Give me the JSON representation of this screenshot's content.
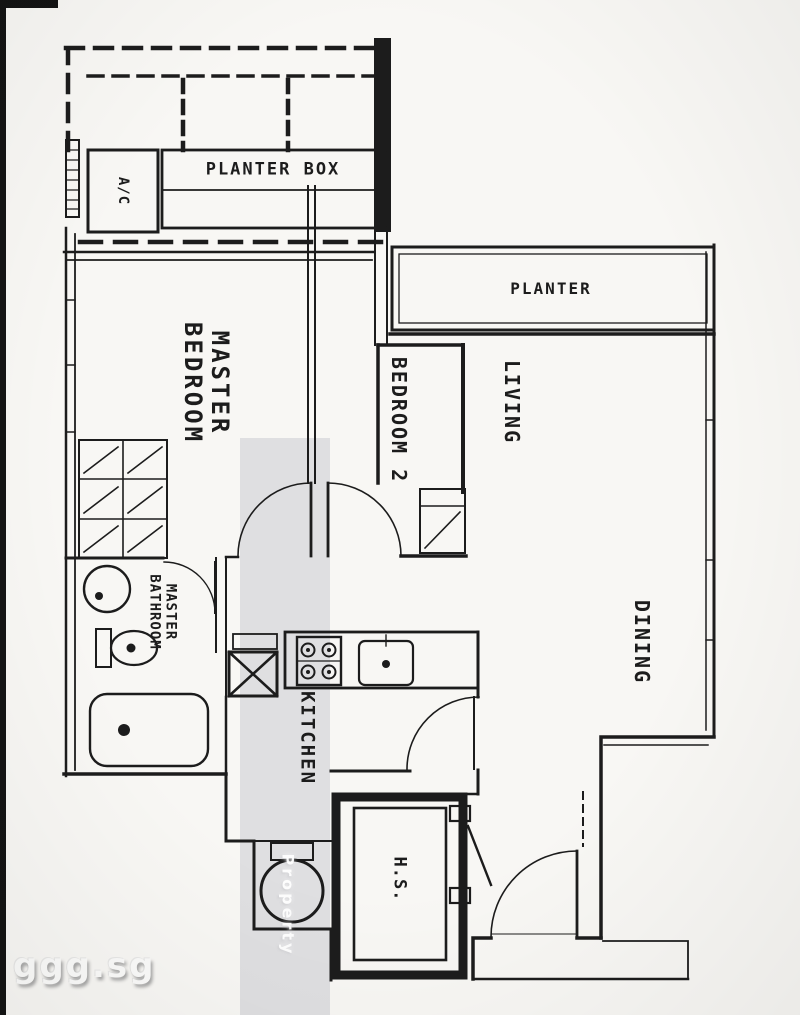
{
  "floorplan": {
    "rooms": {
      "master_bedroom": "MASTER\nBEDROOM",
      "bedroom_2": "BEDROOM 2",
      "living": "LIVING",
      "dining": "DINING",
      "master_bathroom": "MASTER\nBATHROOM",
      "kitchen": "KITCHEN",
      "household_shelter": "H.S."
    },
    "annotations": {
      "planter_box": "PLANTER BOX",
      "planter": "PLANTER",
      "ac_ledge": "A/C"
    },
    "watermarks": {
      "site": "ggg.sg",
      "band_text": "Property"
    },
    "colors": {
      "ink": "#1c1c1c",
      "paper": "#f8f7f4",
      "band": "rgba(197,199,206,0.5)"
    }
  }
}
